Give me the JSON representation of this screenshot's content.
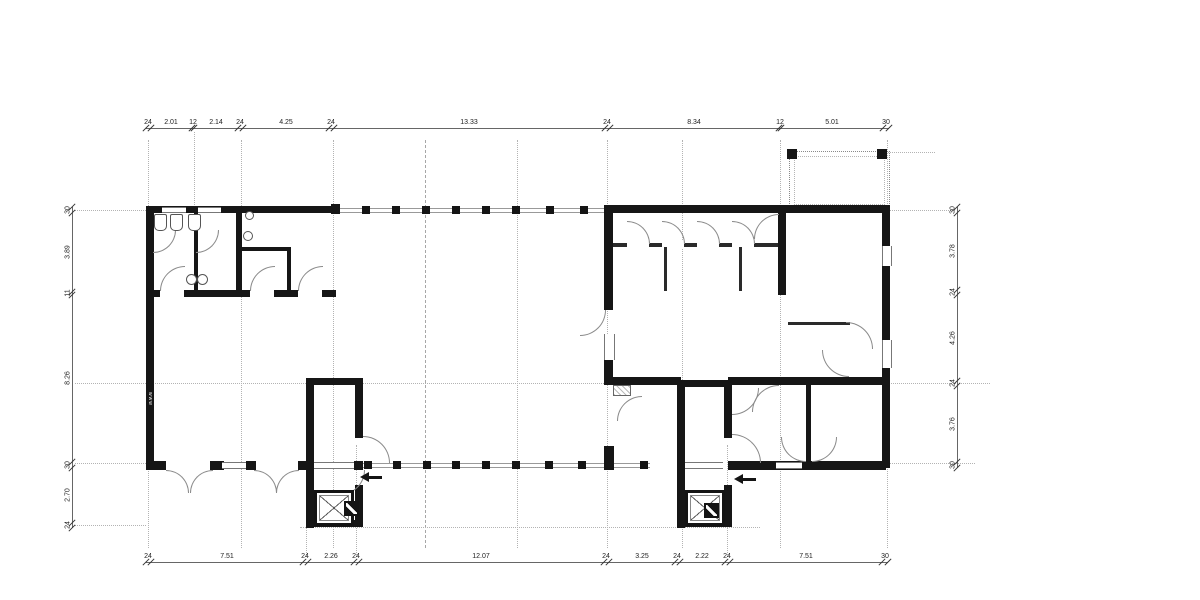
{
  "drawing": {
    "type": "architectural floor plan",
    "watermark": "www"
  },
  "colors": {
    "wall": "#161616",
    "thin_line": "#555555",
    "arc": "#8a8a8a",
    "grid": "#b3b3b3",
    "dim_text": "#222222"
  },
  "dimensions": {
    "chains": [
      {
        "id": "top",
        "orientation": "h",
        "axis": 128,
        "from": 146,
        "to": 889,
        "ticks": [
          146,
          151,
          192,
          194,
          238,
          243,
          329,
          334,
          605,
          610,
          779,
          781,
          883,
          889
        ],
        "labels": [
          {
            "text": "24",
            "pos": 148
          },
          {
            "text": "2.01",
            "pos": 171
          },
          {
            "text": "12",
            "pos": 193
          },
          {
            "text": "2.14",
            "pos": 216
          },
          {
            "text": "24",
            "pos": 240
          },
          {
            "text": "4.25",
            "pos": 286
          },
          {
            "text": "24",
            "pos": 331
          },
          {
            "text": "13.33",
            "pos": 469
          },
          {
            "text": "24",
            "pos": 607
          },
          {
            "text": "8.34",
            "pos": 694
          },
          {
            "text": "12",
            "pos": 780
          },
          {
            "text": "5.01",
            "pos": 832
          },
          {
            "text": "30",
            "pos": 886
          }
        ]
      },
      {
        "id": "bottom",
        "orientation": "h",
        "axis": 562,
        "from": 146,
        "to": 888,
        "ticks": [
          146,
          151,
          303,
          308,
          354,
          359,
          604,
          609,
          675,
          680,
          725,
          730,
          882,
          888
        ],
        "labels": [
          {
            "text": "24",
            "pos": 148
          },
          {
            "text": "7.51",
            "pos": 227
          },
          {
            "text": "24",
            "pos": 305
          },
          {
            "text": "2.26",
            "pos": 331
          },
          {
            "text": "24",
            "pos": 356
          },
          {
            "text": "12.07",
            "pos": 481
          },
          {
            "text": "24",
            "pos": 606
          },
          {
            "text": "3.25",
            "pos": 642
          },
          {
            "text": "24",
            "pos": 677
          },
          {
            "text": "2.22",
            "pos": 702
          },
          {
            "text": "24",
            "pos": 727
          },
          {
            "text": "7.51",
            "pos": 806
          },
          {
            "text": "30",
            "pos": 885
          }
        ]
      },
      {
        "id": "left",
        "orientation": "v",
        "axis": 72,
        "from": 207,
        "to": 528,
        "ticks": [
          207,
          213,
          292,
          295,
          462,
          468,
          523,
          528
        ],
        "labels": [
          {
            "text": "30",
            "pos": 210
          },
          {
            "text": "3.89",
            "pos": 252
          },
          {
            "text": "11",
            "pos": 293
          },
          {
            "text": "8.26",
            "pos": 378
          },
          {
            "text": "30",
            "pos": 465
          },
          {
            "text": "2.70",
            "pos": 495
          },
          {
            "text": "24",
            "pos": 525
          }
        ]
      },
      {
        "id": "right",
        "orientation": "v",
        "axis": 957,
        "from": 207,
        "to": 468,
        "ticks": [
          207,
          213,
          290,
          295,
          381,
          386,
          462,
          468
        ],
        "labels": [
          {
            "text": "30",
            "pos": 210
          },
          {
            "text": "3.78",
            "pos": 251
          },
          {
            "text": "24",
            "pos": 292
          },
          {
            "text": "4.26",
            "pos": 338
          },
          {
            "text": "24",
            "pos": 383
          },
          {
            "text": "3.76",
            "pos": 424
          },
          {
            "text": "30",
            "pos": 465
          }
        ]
      }
    ]
  },
  "grid": {
    "verticals": [
      {
        "x": 148
      },
      {
        "x": 241
      },
      {
        "x": 333
      },
      {
        "x": 425,
        "style": "dash"
      },
      {
        "x": 517
      },
      {
        "x": 607
      },
      {
        "x": 682
      },
      {
        "x": 780
      },
      {
        "x": 887
      }
    ],
    "vertical_extent": {
      "y1": 140,
      "y2": 548
    },
    "stubs": [
      {
        "x": 194,
        "y": 132,
        "h": 85
      },
      {
        "x": 306,
        "y": 445,
        "h": 112
      },
      {
        "x": 356,
        "y": 445,
        "h": 112
      },
      {
        "x": 727,
        "y": 445,
        "h": 112
      }
    ],
    "horizontals": [
      {
        "x": 75,
        "y": 210,
        "w": 71
      },
      {
        "x": 888,
        "y": 210,
        "w": 67
      },
      {
        "x": 75,
        "y": 383,
        "w": 915
      },
      {
        "x": 75,
        "y": 463,
        "w": 71
      },
      {
        "x": 888,
        "y": 463,
        "w": 87
      },
      {
        "x": 75,
        "y": 525,
        "w": 71
      },
      {
        "x": 300,
        "y": 527,
        "w": 460
      },
      {
        "x": 888,
        "y": 152,
        "w": 47
      }
    ]
  },
  "glazing_columns": {
    "top": [
      362,
      392,
      422,
      452,
      482,
      512,
      546,
      580
    ],
    "bottom": [
      364,
      393,
      423,
      452,
      482,
      512,
      545,
      578,
      640
    ]
  }
}
